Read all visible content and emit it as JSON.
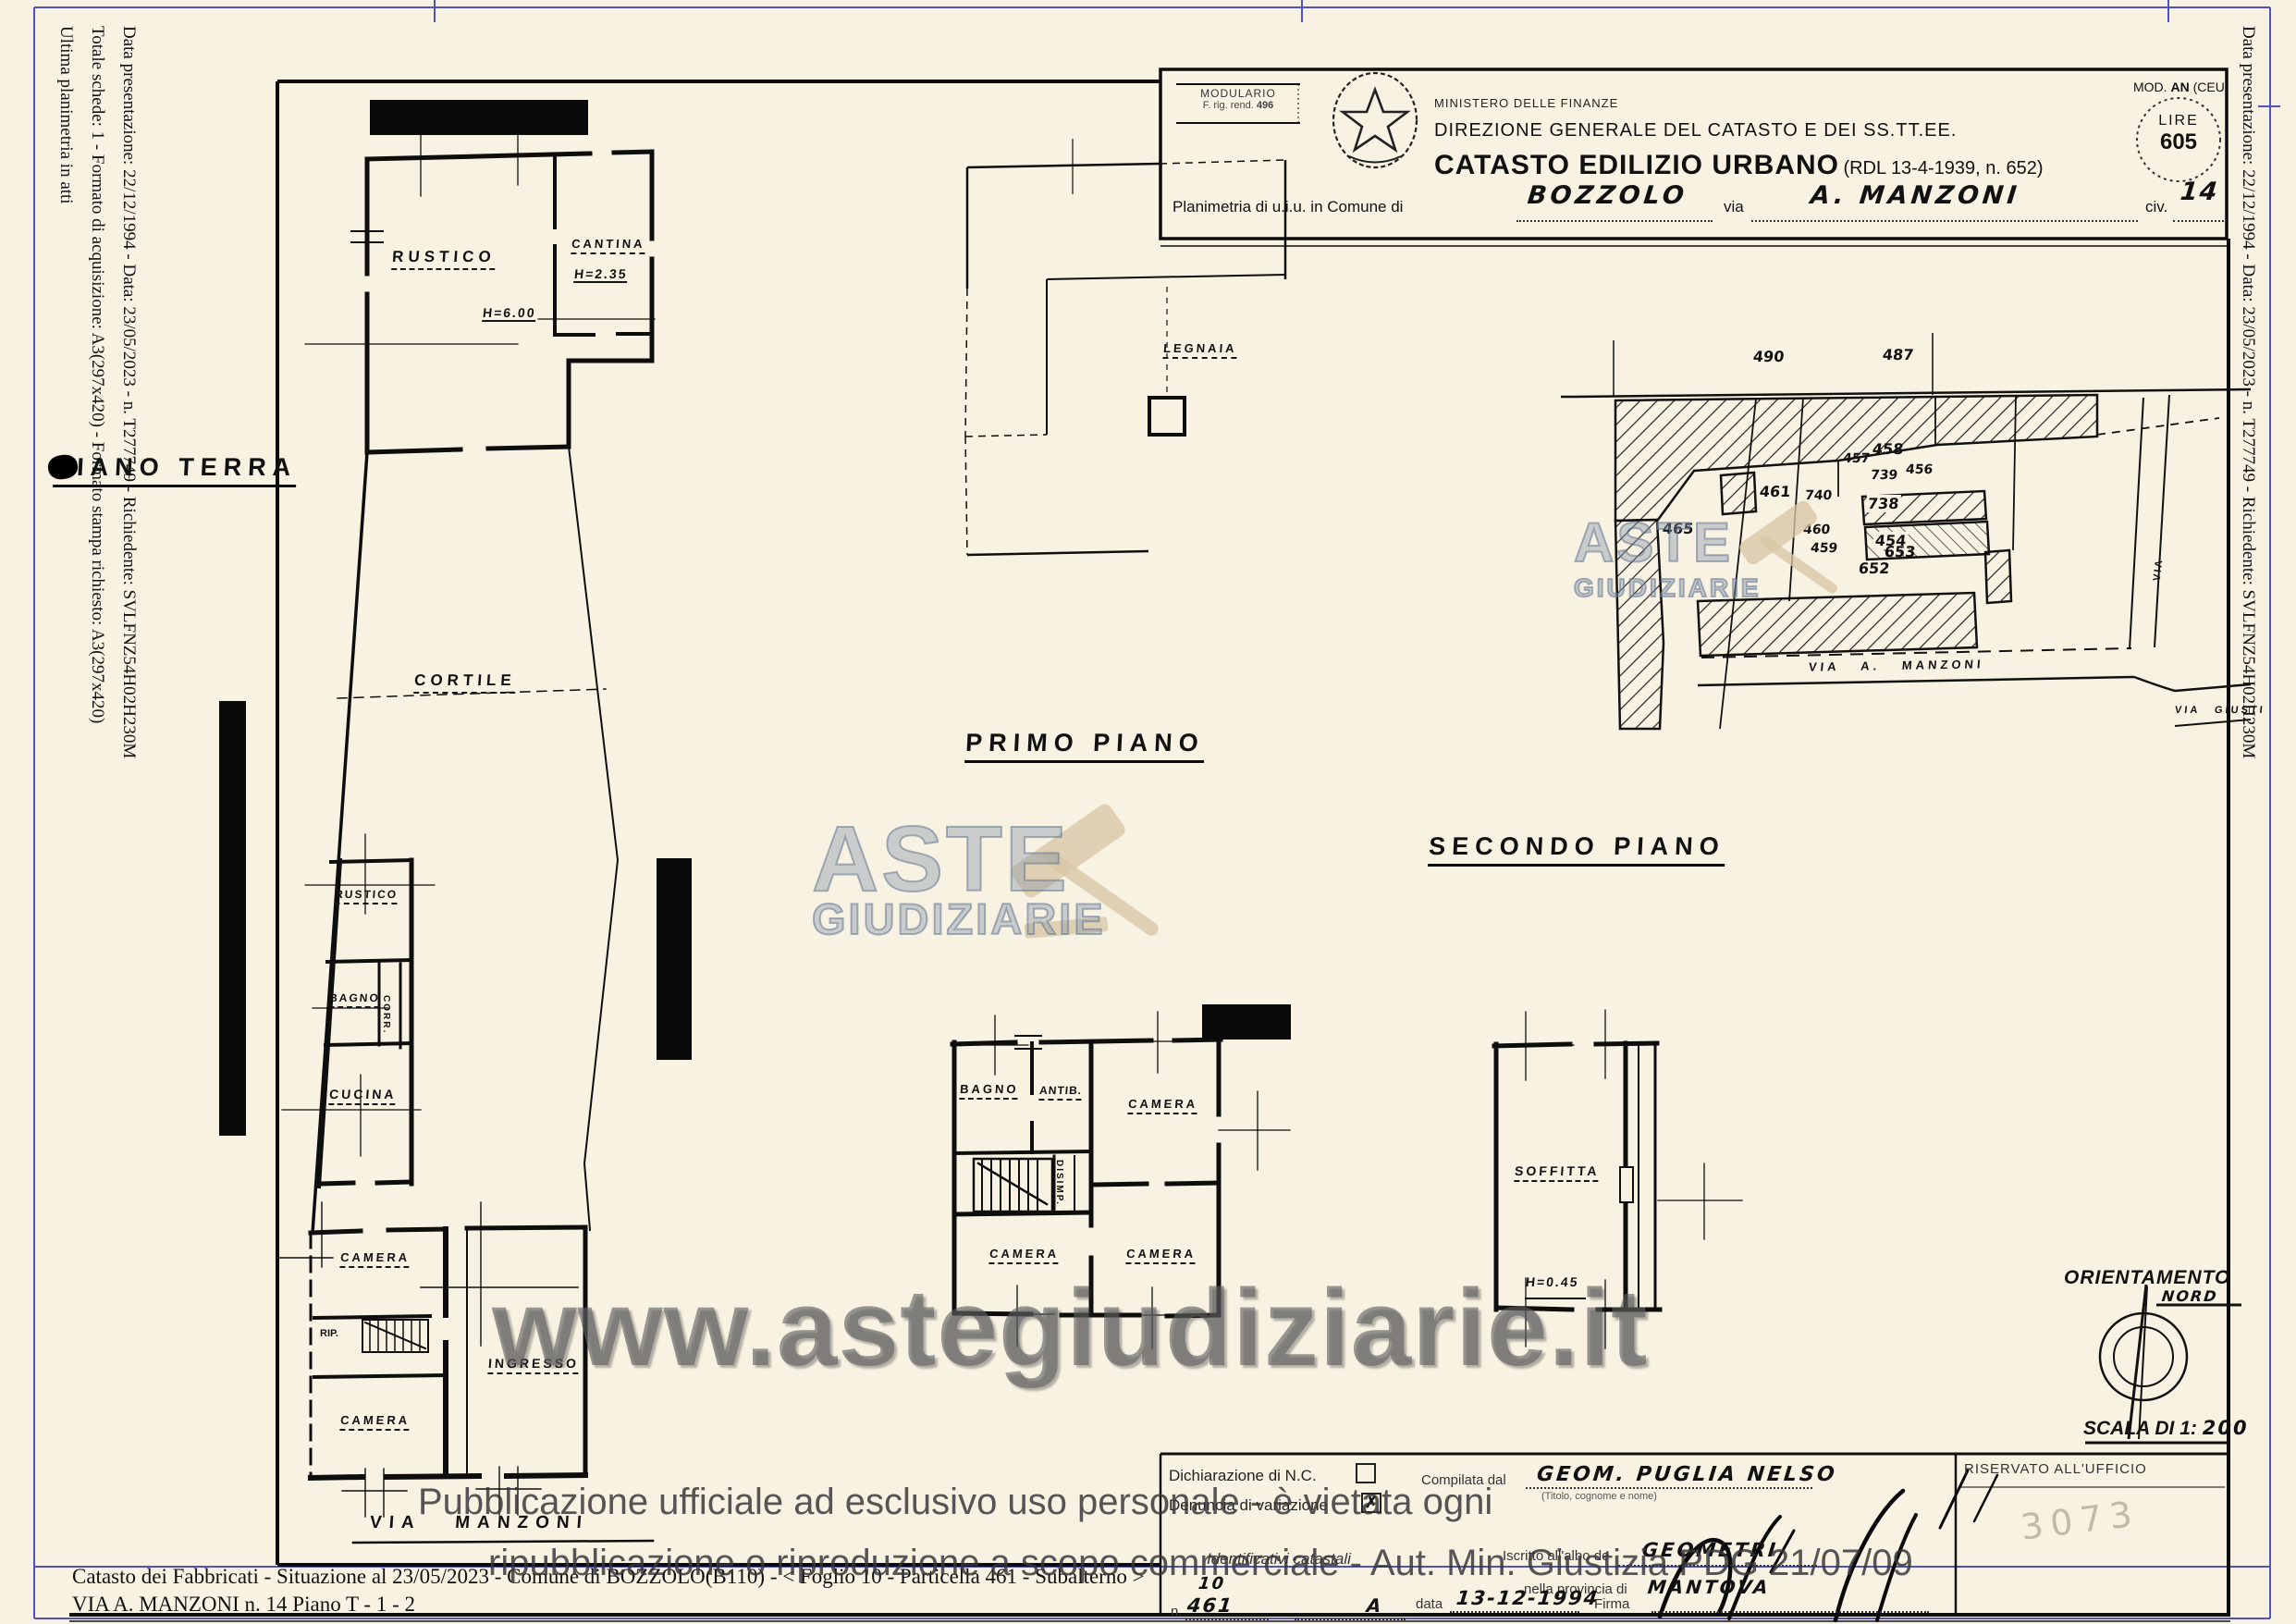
{
  "colors": {
    "paper": "#f8f2e2",
    "ink": "#111111",
    "frame_blue": "#3434c8",
    "logo_blue": "#8193aa",
    "gavel_tan": "#d7c6a5",
    "watermark_gray": "#5f5f5f"
  },
  "sidebars": {
    "left": [
      "Data presentazione: 22/12/1994 - Data: 23/05/2023 - n. T277749 - Richiedente: SVLFNZ54H02H230M",
      "Totale schede: 1 - Formato di acquisizione: A3(297x420) - Formato stampa richiesto: A3(297x420)",
      "Ultima planimetria in atti"
    ],
    "right": "Data presentazione: 22/12/1994 - Data: 23/05/2023 - n. T277749 - Richiedente: SVLFNZ54H02H230M"
  },
  "header": {
    "modulario_line1": "MODULARIO",
    "modulario_line2": "F. rig. rend.",
    "modulario_num": "496",
    "ministry1": "MINISTERO DELLE FINANZE",
    "ministry2": "DIREZIONE GENERALE DEL CATASTO E DEI SS.TT.EE.",
    "title": "CATASTO EDILIZIO URBANO",
    "title_ref": "(RDL 13-4-1939, n. 652)",
    "mod_prefix": "MOD. ",
    "mod_bold": "AN",
    "mod_suffix": " (CEU)",
    "lire_label": "LIRE",
    "lire_value": "605",
    "plan_prefix": "Planimetria di u.i.u. in Comune di",
    "comune": "BOZZOLO",
    "via_label": "via",
    "via_value": "A. MANZONI",
    "civ_label": "civ.",
    "civ_value": "14"
  },
  "plans": {
    "piano_terra": {
      "title": "PIANO TERRA",
      "rustico1": "RUSTICO",
      "cantina": "CANTINA",
      "h_cantina": "H=2.35",
      "h_rustico": "H=6.00",
      "cortile": "CORTILE",
      "rustico2": "RUSTICO",
      "bagno": "BAGNO",
      "corr": "CORR.",
      "cucina": "CUCINA",
      "camera1": "CAMERA",
      "rip": "RIP.",
      "ingresso": "INGRESSO",
      "camera2": "CAMERA",
      "street": "VIA  MANZONI"
    },
    "primo_piano": {
      "title": "PRIMO PIANO",
      "legnaia": "LEGNAIA",
      "bagno": "BAGNO",
      "antib": "ANTIB.",
      "camera_nord": "CAMERA",
      "disimp": "DISIMP.",
      "camera_ovest": "CAMERA",
      "camera_sud": "CAMERA"
    },
    "secondo_piano": {
      "title": "SECONDO PIANO",
      "soffitta": "SOFFITTA",
      "h": "H=0.45"
    }
  },
  "map": {
    "parcels": [
      "490",
      "487",
      "465",
      "461",
      "740",
      "460",
      "459",
      "458",
      "457",
      "739",
      "456",
      "738",
      "454",
      "653",
      "652"
    ],
    "street_manzoni": "VIA  A.  MANZONI",
    "street_giusti": "VIA GIUSTI",
    "street_side": "VIA"
  },
  "compass": {
    "title": "ORIENTAMENTO",
    "north": "NORD",
    "scale_label": "SCALA DI 1:",
    "scale_value": "200"
  },
  "form": {
    "decl1": "Dichiarazione di N.C.",
    "decl2": "Denuncia di variazione",
    "check2": "✗",
    "compilata_label": "Compilata dal",
    "compilata_value": "GEOM. PUGLIA NELSO",
    "compilata_note": "(Titolo, cognome e nome)",
    "ident_label": "Identificativi catastali",
    "n_label": "n.",
    "foglio_value": "10",
    "particella_value": "461",
    "sub_value": "A",
    "albo_label": "Iscritto all'albo de",
    "albo_value": "GEOMETRI",
    "prov_label": "nella provincia di",
    "prov_value": "MANTOVA",
    "data_label": "data",
    "data_value": "13-12-1994",
    "firma_label": "Firma",
    "riservato": "RISERVATO ALL'UFFICIO",
    "riservato_hw": "3073"
  },
  "watermarks": {
    "aste1": "ASTE",
    "aste2": "GIUDIZIARIE",
    "url": "www.astegiudiziarie.it",
    "notice1": "Pubblicazione ufficiale ad esclusivo uso personale - è vietata ogni",
    "notice2": "ripubblicazione o riproduzione a scopo commerciale - Aut. Min. Giustizia PDG 21/07/09"
  },
  "footer": {
    "line1": "Catasto dei Fabbricati - Situazione al 23/05/2023 - Comune di BOZZOLO(B110) - <  Foglio 10 - Particella  461 - Subalterno   >",
    "line2": "VIA A. MANZONI n. 14 Piano T - 1 - 2"
  }
}
